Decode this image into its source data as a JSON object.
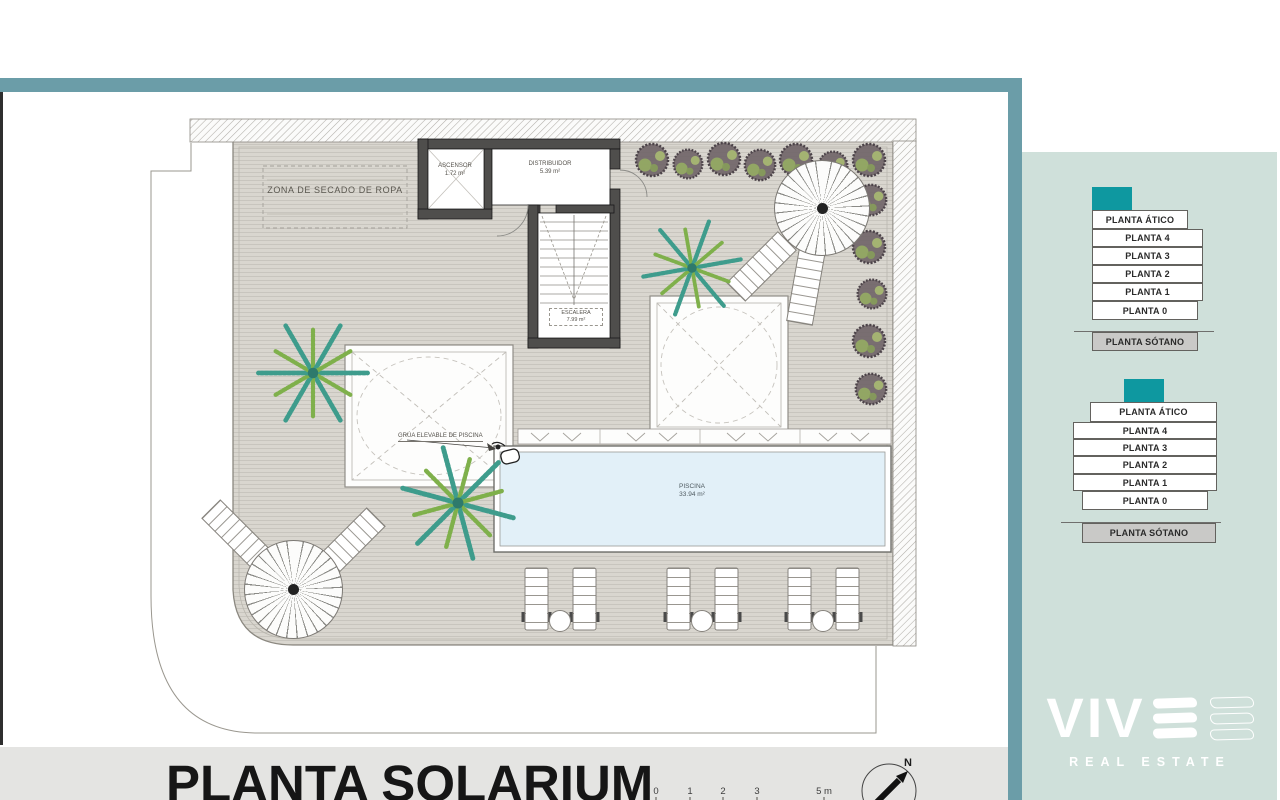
{
  "plan": {
    "title": "PLANTA SOLARIUM",
    "compass": "N",
    "scale_ticks": [
      "0",
      "1",
      "2",
      "3",
      "5 m"
    ],
    "rooms": {
      "drying_zone": "ZONA DE SECADO DE ROPA",
      "elevator_name": "ASCENSOR",
      "elevator_area": "1.72 m²",
      "hall_name": "DISTRIBUIDOR",
      "hall_area": "5.39 m²",
      "stairs_name": "ESCALERA",
      "stairs_area": "7.99 m²",
      "pool_name": "PISCINA",
      "pool_area": "33.94 m²",
      "pool_lift": "GRÚA ELEVABLE DE PISCINA"
    }
  },
  "sidebar": {
    "floors": [
      "PLANTA ÁTICO",
      "PLANTA 4",
      "PLANTA 3",
      "PLANTA 2",
      "PLANTA 1",
      "PLANTA 0",
      "PLANTA SÓTANO"
    ],
    "logo": {
      "brand": "VIV",
      "tagline": "REAL ESTATE"
    }
  },
  "colors": {
    "top_bar": "#6b9da8",
    "side_strip": "#6b9da8",
    "sidebar_panel": "#cfe0da",
    "floor_accent_teal": "#0e98a0",
    "sotano_gray": "#c9c9c7",
    "bottom_band": "#e4e4e2",
    "pool_water": "#e2f0f8",
    "deck": "#d9d6cf"
  }
}
